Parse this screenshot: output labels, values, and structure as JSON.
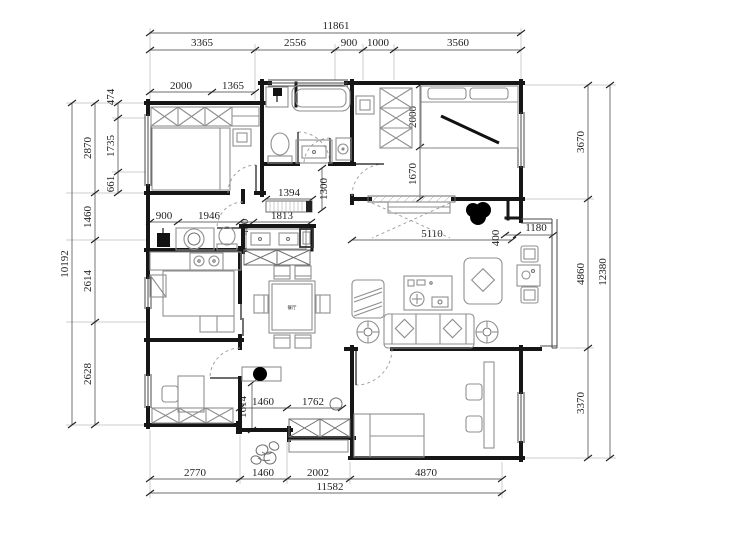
{
  "meta": {
    "drawing_type": "apartment floor plan",
    "units": "mm"
  },
  "colors": {
    "wall": "#161616",
    "furniture": "#8f8f8f",
    "dimension": "#3c3c3c",
    "fill_black": "#000000",
    "background": "#ffffff"
  },
  "dims": {
    "top_total": "11861",
    "top_segments": [
      "3365",
      "2556",
      "900",
      "1000",
      "3560"
    ],
    "left_total": "10192",
    "left_segments": [
      "2870",
      "1460",
      "2614",
      "2628"
    ],
    "left_subsegments": [
      "474",
      "1735",
      "661"
    ],
    "right_total": "12380",
    "right_segments": [
      "3670",
      "4860",
      "3370"
    ],
    "bottom_total": "11582",
    "bottom_segments": [
      "2770",
      "1460",
      "2002",
      "4870"
    ],
    "interior": {
      "bedroom1_width_a": "2000",
      "bedroom1_width_b": "1365",
      "hall_console_width": "1394",
      "hall_height": "1300",
      "master_bed_width": "2000",
      "master_lower": "1670",
      "hall_a": "900",
      "hall_b": "1946",
      "hall_c": "460",
      "hall_d": "1813",
      "living_width": "5110",
      "entry_a": "400",
      "entry_b": "1180",
      "corridor_height": "1614",
      "corridor_a": "1460",
      "corridor_b": "1762"
    }
  },
  "labels": {
    "dining_table": "餐厅"
  }
}
